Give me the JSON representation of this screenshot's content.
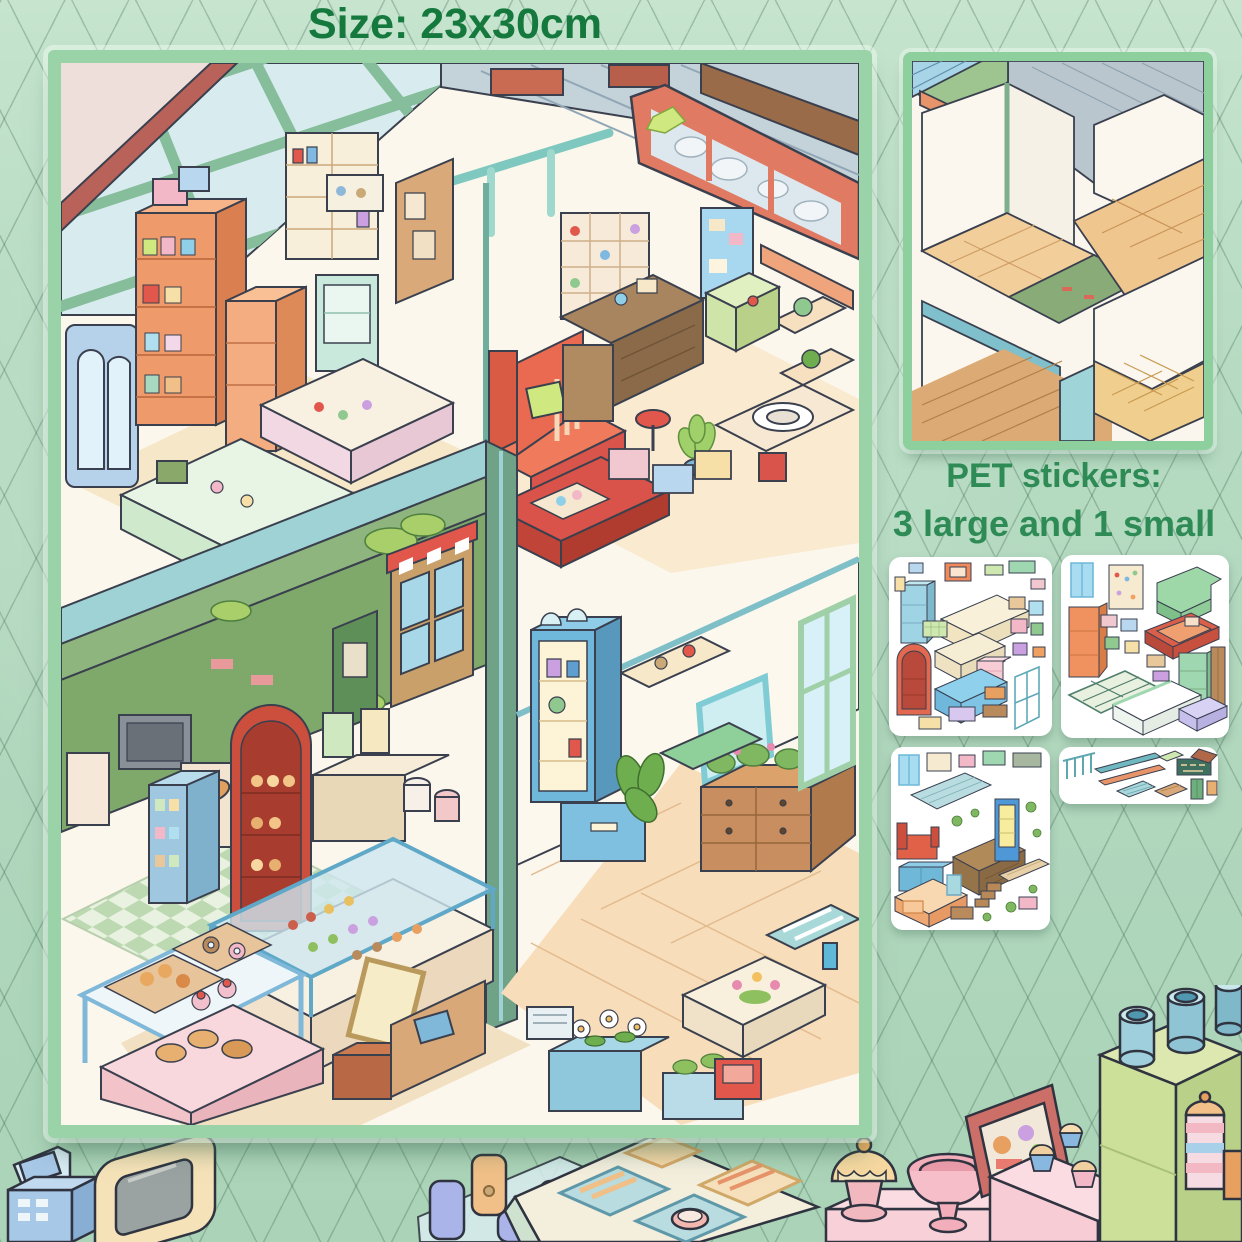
{
  "background": {
    "color": "#b6dbc2",
    "grid_color": "#3e6650"
  },
  "title": {
    "text": "Size: 23x30cm",
    "color": "#15793d"
  },
  "sticker_note": {
    "line1": "PET stickers:",
    "line2": "3 large and 1 small",
    "color": "#2e8b55"
  },
  "poster": {
    "label": "four-room isometric miniature shop poster",
    "frame_color": "#9bd3a9"
  },
  "preview": {
    "label": "empty isometric rooms base",
    "frame_color": "#8ecf9e"
  },
  "sheets": [
    {
      "label": "large furniture sticker sheet 1"
    },
    {
      "label": "large furniture sticker sheet 2"
    },
    {
      "label": "large furniture sticker sheet 3"
    },
    {
      "label": "small accessories sticker sheet"
    }
  ]
}
